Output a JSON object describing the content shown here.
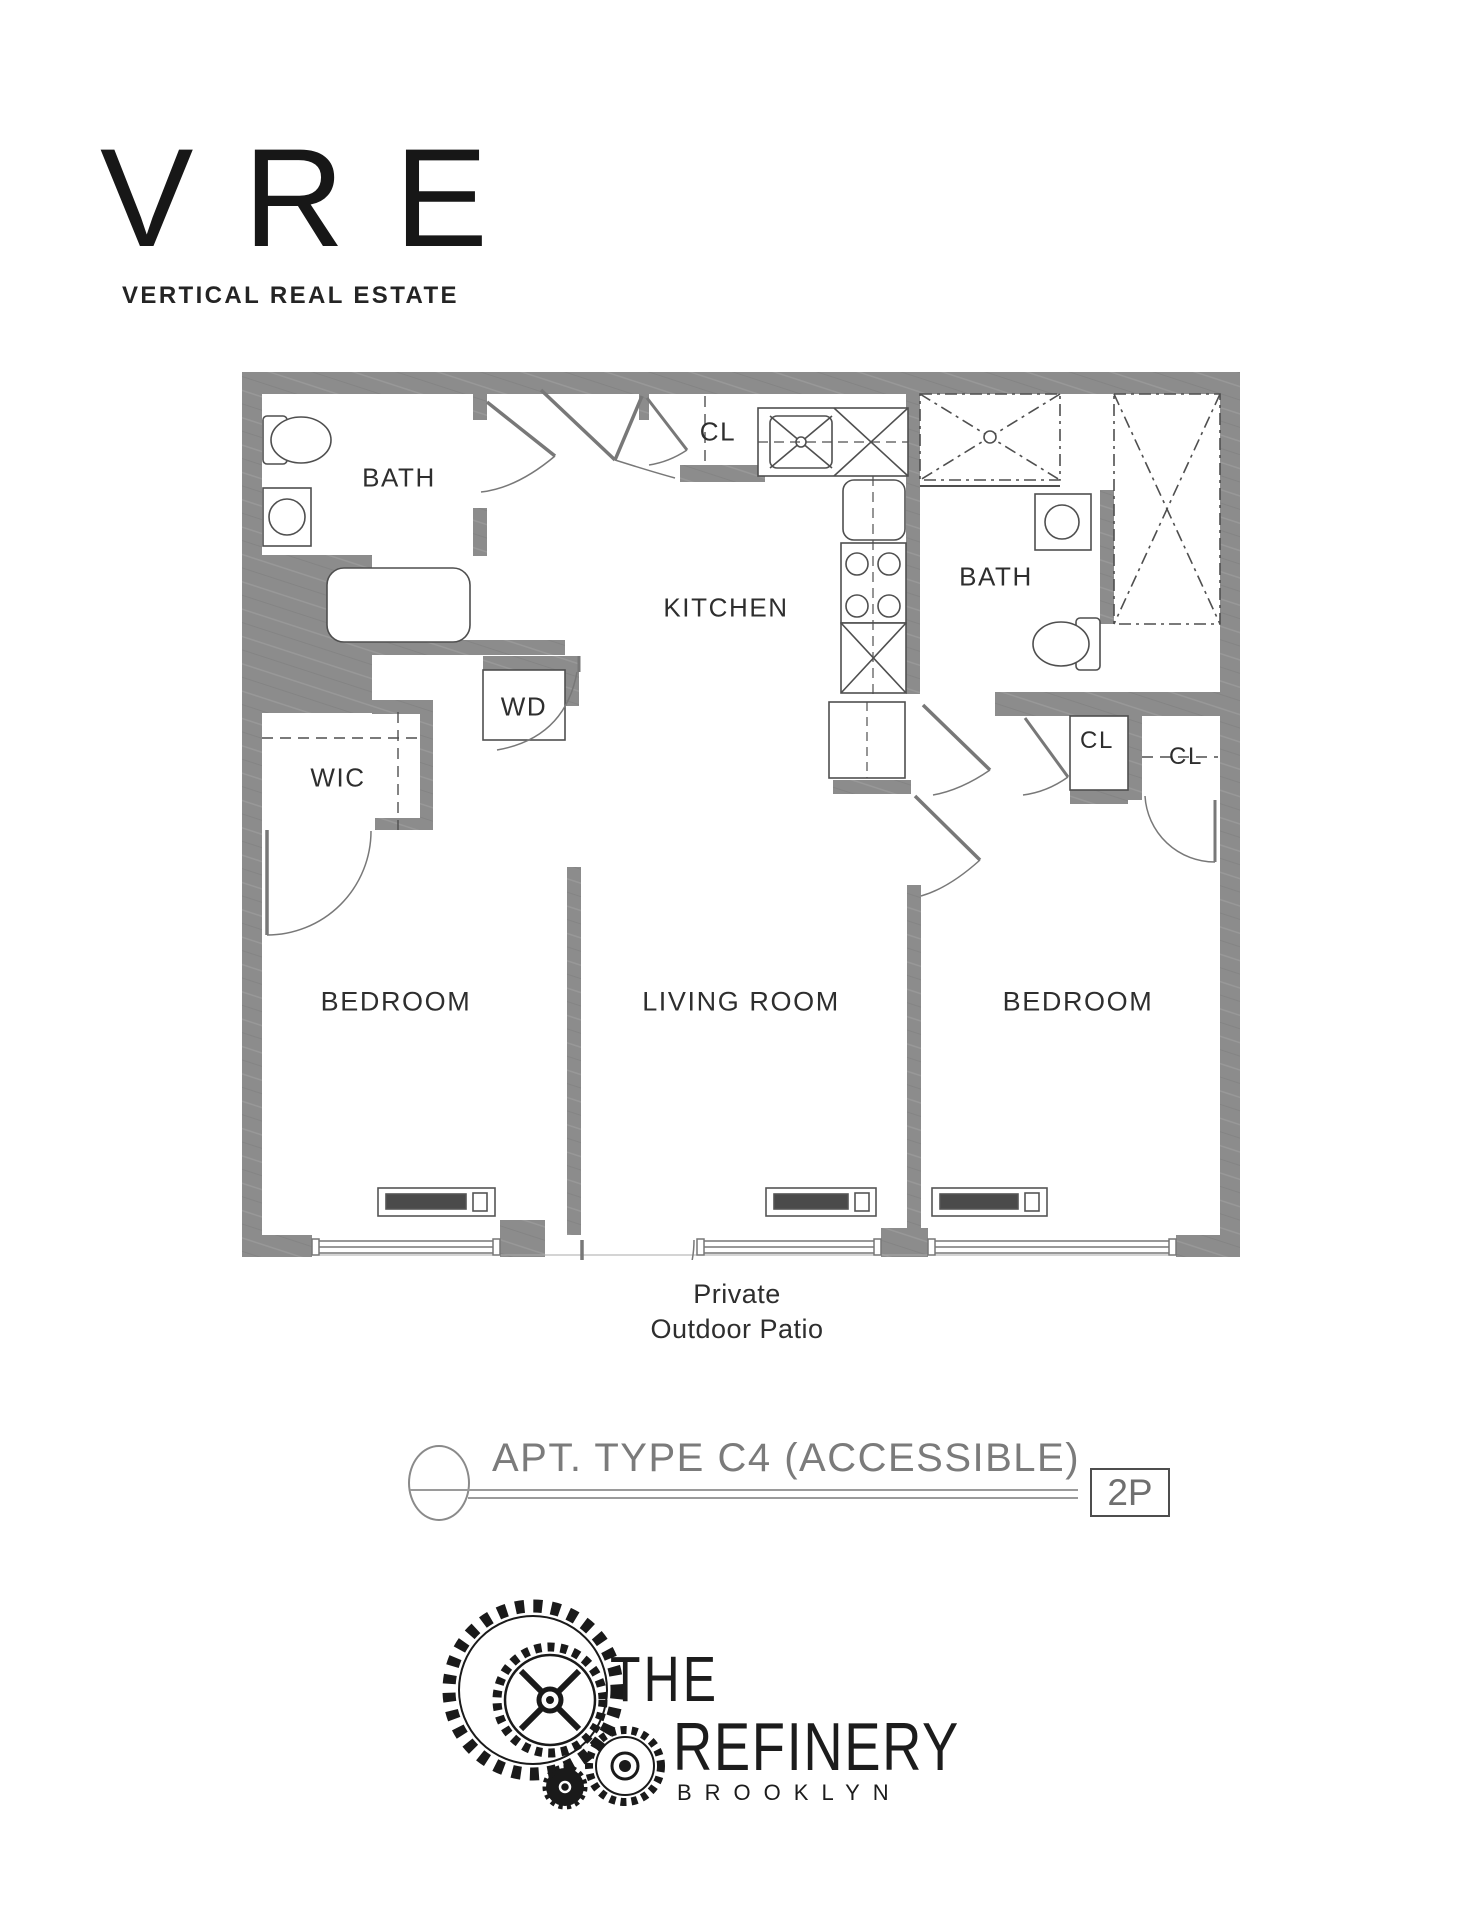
{
  "brand": {
    "logo": "VRE",
    "tagline": "VERTICAL REAL ESTATE"
  },
  "plan": {
    "labels": {
      "bath_left": "BATH",
      "closet_top": "CL",
      "kitchen": "KITCHEN",
      "bath_right": "BATH",
      "washer_dryer": "WD",
      "walk_in_closet": "WIC",
      "closet_right_1": "CL",
      "closet_right_2": "CL",
      "bedroom_left": "BEDROOM",
      "living_room": "LIVING ROOM",
      "bedroom_right": "BEDROOM",
      "patio_line_1": "Private",
      "patio_line_2": "Outdoor Patio"
    }
  },
  "title_block": {
    "apartment_type": "APT. TYPE C4 (ACCESSIBLE)",
    "occupancy": "2P"
  },
  "development": {
    "name_line_1": "THE",
    "name_line_2": "REFINERY",
    "name_line_3": "BROOKLYN"
  },
  "colors": {
    "wall": "#8c8c8c",
    "fixture_line": "#4f4f4f",
    "label_text": "#2e2e2e",
    "title_text": "#7b7b7b"
  }
}
